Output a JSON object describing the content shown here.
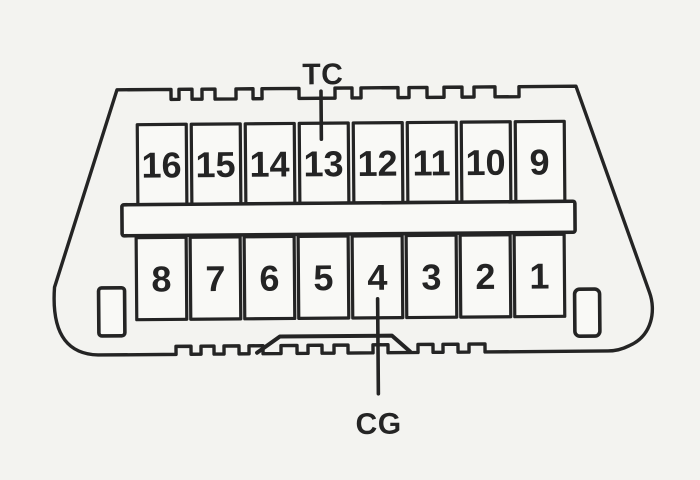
{
  "diagram": {
    "labels": {
      "tc": "TC",
      "cg": "CG"
    },
    "pins": {
      "top_row": [
        "16",
        "15",
        "14",
        "13",
        "12",
        "11",
        "10",
        "9"
      ],
      "bottom_row": [
        "8",
        "7",
        "6",
        "5",
        "4",
        "3",
        "2",
        "1"
      ]
    },
    "colors": {
      "line": "#262626",
      "background": "#f3f3f0",
      "cell_fill": "#f7f7f4"
    }
  }
}
